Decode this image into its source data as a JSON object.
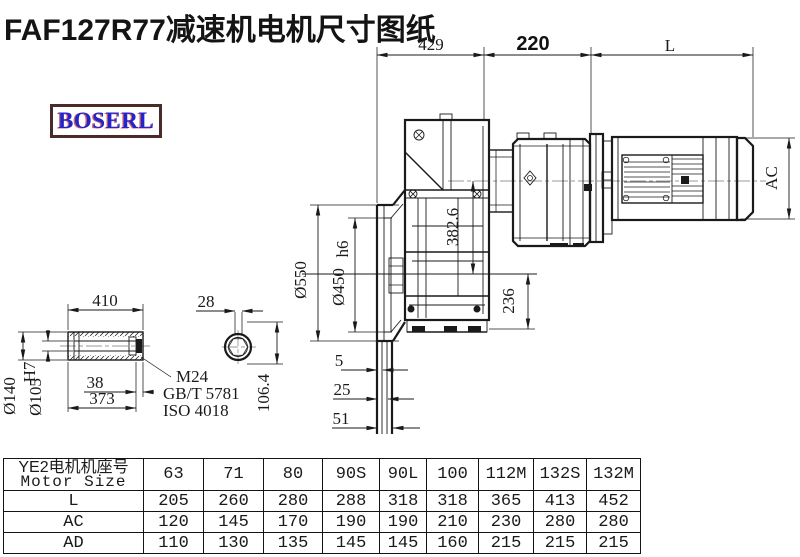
{
  "title": "FAF127R77减速机电机尺寸图纸",
  "logo": {
    "text": "BOSERL"
  },
  "colors": {
    "line": "#1a1a1a",
    "logo_text": "#2424cc",
    "logo_border": "#4a2b28",
    "centerline": "#9a9a9a"
  },
  "drawing": {
    "top_dims": {
      "d429": "429",
      "d220": "220",
      "dL": "L"
    },
    "main_view": {
      "d382_6": "382.6",
      "d236": "236",
      "dAC": "AC",
      "d550": "Ø550",
      "d450": "Ø450",
      "d450_tol": "h6",
      "d5": "5",
      "d25": "25",
      "d51": "51"
    },
    "shaft_view": {
      "d410": "410",
      "d38": "38",
      "d373": "373",
      "d140": "Ø140",
      "d105": "Ø105",
      "d105_tol": "H7",
      "bolt_line1": "M24",
      "bolt_line2": "GB/T 5781",
      "bolt_line3": "ISO 4018"
    },
    "end_view": {
      "d28": "28",
      "d106_4": "106.4"
    }
  },
  "table": {
    "header_cn": "YE2电机机座号",
    "header_en": "Motor Size",
    "columns": [
      "63",
      "71",
      "80",
      "90S",
      "90L",
      "100",
      "112M",
      "132S",
      "132M"
    ],
    "rows": [
      {
        "label": "L",
        "values": [
          "205",
          "260",
          "280",
          "288",
          "318",
          "318",
          "365",
          "413",
          "452"
        ]
      },
      {
        "label": "AC",
        "values": [
          "120",
          "145",
          "170",
          "190",
          "190",
          "210",
          "230",
          "280",
          "280"
        ]
      },
      {
        "label": "AD",
        "values": [
          "110",
          "130",
          "135",
          "145",
          "145",
          "160",
          "215",
          "215",
          "215"
        ]
      }
    ]
  }
}
